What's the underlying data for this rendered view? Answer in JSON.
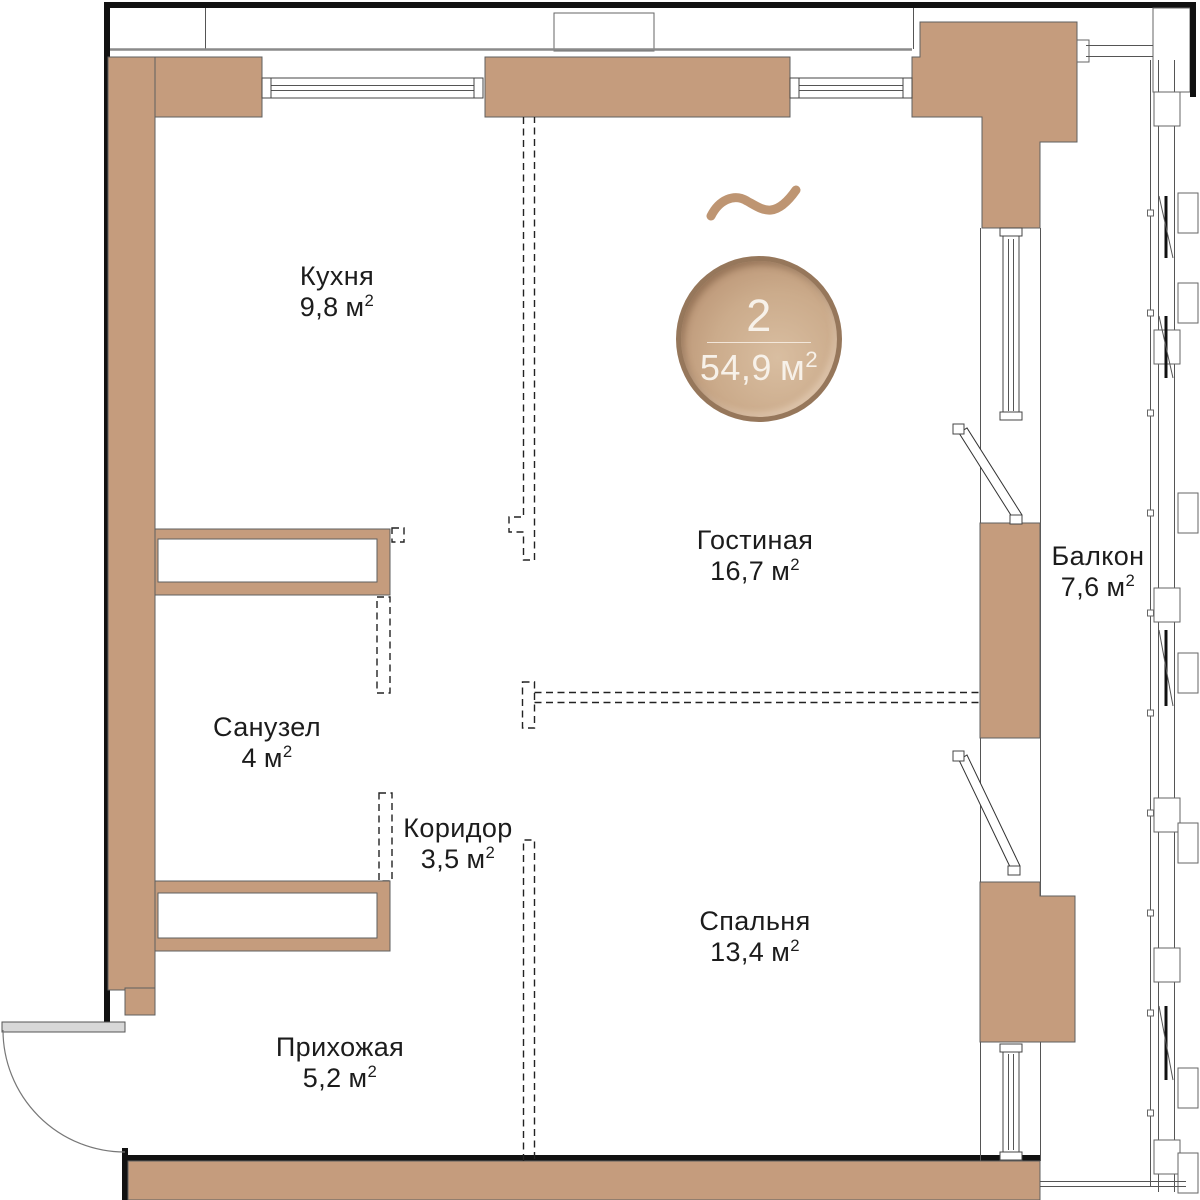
{
  "plan": {
    "type": "apartment-floor-plan",
    "language": "ru",
    "unit": "м",
    "unit_sup": "2",
    "badge": {
      "rooms_count": "2",
      "total_area": "54,9"
    },
    "rooms": [
      {
        "id": "kitchen",
        "name": "Кухня",
        "area": "9,8"
      },
      {
        "id": "living",
        "name": "Гостиная",
        "area": "16,7"
      },
      {
        "id": "bathroom",
        "name": "Санузел",
        "area": "4"
      },
      {
        "id": "corridor",
        "name": "Коридор",
        "area": "3,5"
      },
      {
        "id": "bedroom",
        "name": "Спальня",
        "area": "13,4"
      },
      {
        "id": "hallway",
        "name": "Прихожая",
        "area": "5,2"
      },
      {
        "id": "balcony",
        "name": "Балкон",
        "area": "7,6"
      }
    ],
    "colors": {
      "wall_fill": "#C59C7D",
      "badge_rim": "#96775B",
      "badge_text": "#F7F1E9",
      "wave": "#BE9572",
      "line": "#555555",
      "outer_frame": "#111111",
      "label_text": "#1C1C1C"
    }
  }
}
